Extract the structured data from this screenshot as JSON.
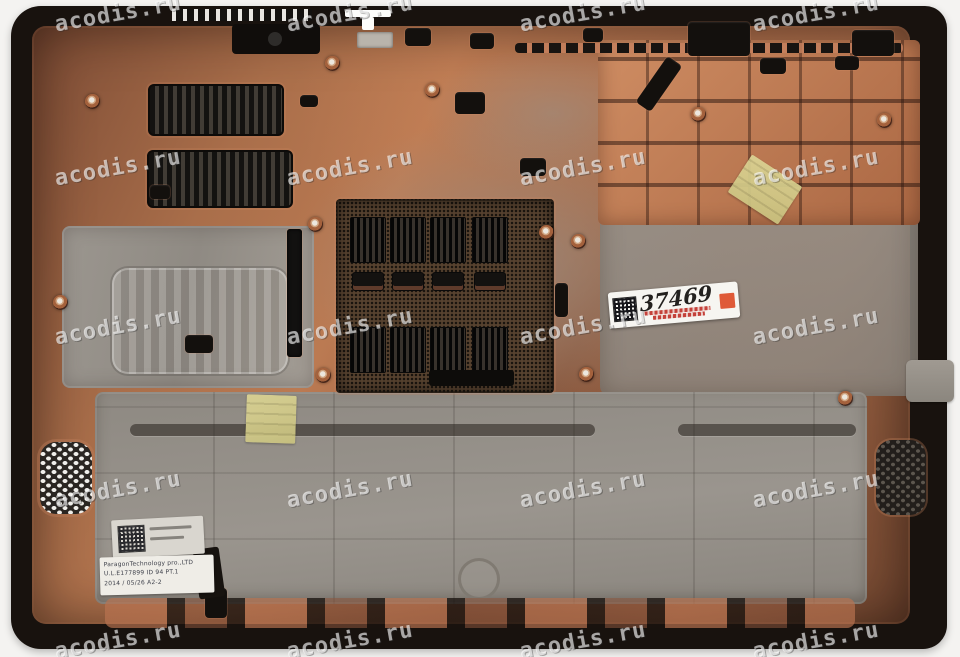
{
  "photo": {
    "subject": "laptop-bottom-case-interior",
    "background_color": "#f4f3f1",
    "watermark": {
      "text": "acodis.ru",
      "color": "#ffffff",
      "opacity": 0.62
    },
    "inventory_sticker": {
      "handwritten_number": "37469",
      "square_color": "#df5a38"
    },
    "info_label": {
      "line1": "ParagonTechnology pro.,LTD",
      "line2": "U.L.E177899  ID 94 PT.1",
      "line3": "2014 / 05/26      A2-2"
    },
    "colors": {
      "case_rim": "#18120e",
      "copper": "#a96e4a",
      "copper_bright": "#cd8a60",
      "panel_gray": "#938e87",
      "mesh_dark": "#57422f",
      "tape_yellow": "#d8d18e"
    }
  }
}
